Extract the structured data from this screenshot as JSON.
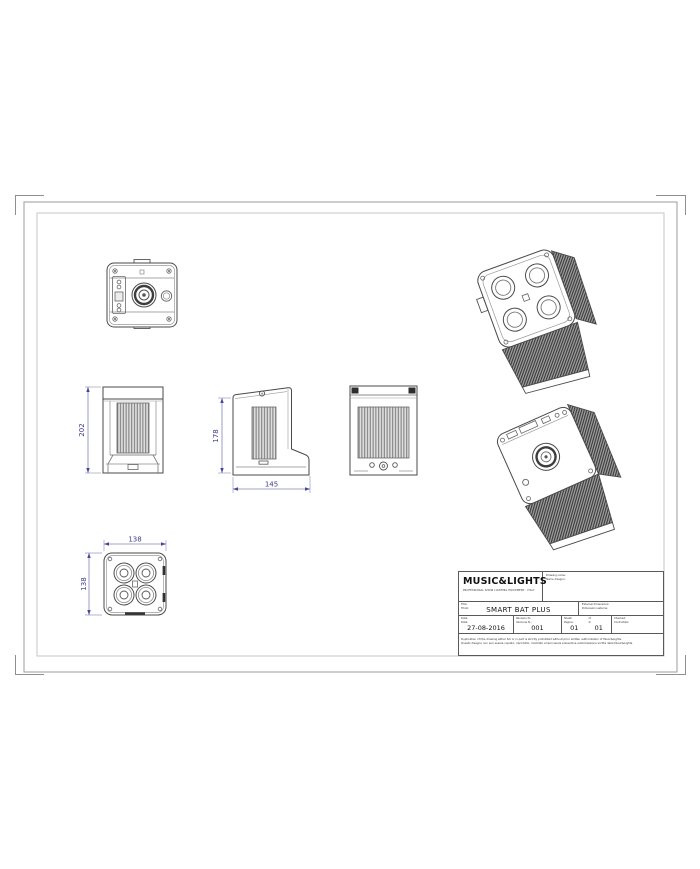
{
  "dims": {
    "front_height": "202",
    "side_height": "178",
    "side_depth": "145",
    "bottom_width": "138",
    "bottom_depth": "138"
  },
  "title_block": {
    "logo": "MUSIC&LIGHTS",
    "tagline": "PROFESSIONAL SHOW LIGHTING EQUIPMENT · ITALY",
    "drawing_name_label_en": "Drawing name:",
    "drawing_name_label_it": "Nome disegno:",
    "title_label_en": "Title:",
    "title_label_it": "Titolo:",
    "title_value": "SMART BAT PLUS",
    "dimensions_label_en": "External dimensions:",
    "dimensions_label_it": "Dimensioni esterne:",
    "date_label_en": "Date:",
    "date_label_it": "Data:",
    "date_value": "27-08-2016",
    "revision_label_en": "Revision N.:",
    "revision_label_it": "Versione N.:",
    "revision_value": "001",
    "sheet_label_en": "Sheet:",
    "sheet_label_it": "Pagine:",
    "sheet_value": "01",
    "of_label_en": "of",
    "of_label_it": "di",
    "of_value": "01",
    "checked_label_en": "Checked:",
    "checked_label_it": "Controllato:",
    "checked_value": "",
    "disclaimer_en": "Duplication of this drawing either full or in part is strictly prohibited without prior written authorization of Music&Lights.",
    "disclaimer_it": "Questo disegno non può essere copiato, riprodotto, mostrato a terzi senza preventiva autorizzazione scritta della Music&Lights."
  },
  "colors": {
    "dimension_text": "#3b3b8c",
    "outline": "#4a4a4a"
  }
}
